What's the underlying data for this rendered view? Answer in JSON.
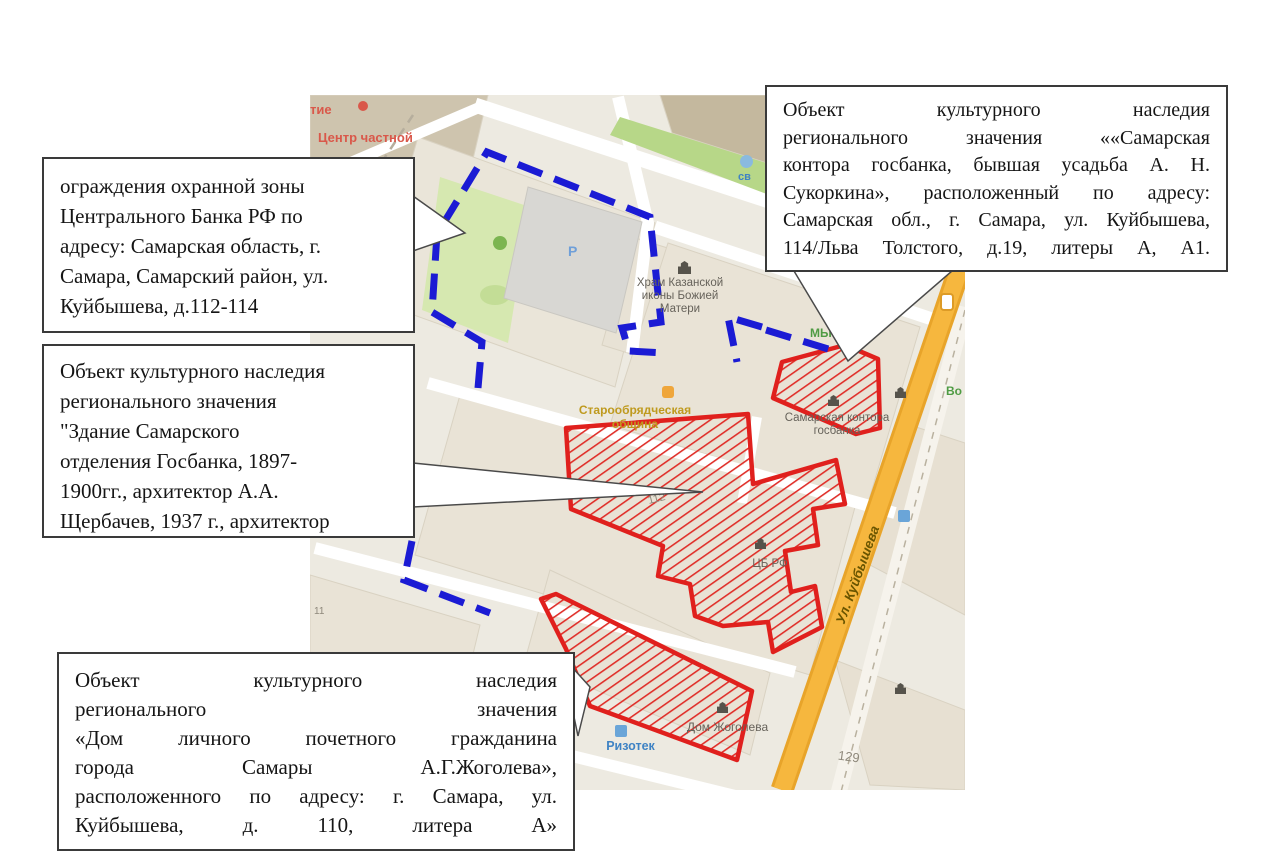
{
  "figure": {
    "boxes": {
      "protection_zone": {
        "lines": [
          "ограждения охранной зоны",
          "Центрального Банка РФ по",
          "адресу: Самарская область, г.",
          "Самара, Самарский район, ул.",
          "Куйбышева, д.112-114"
        ]
      },
      "gosbank_building": {
        "lines": [
          "Объект культурного наследия",
          "регионального значения",
          "\"Здание Самарского",
          "отделения Госбанка, 1897-",
          "1900гг., архитектор А.А.",
          "Щербачев, 1937 г., архитектор"
        ]
      },
      "kontora_gosbanka": {
        "lines": [
          "Объект культурного наследия",
          "регионального значения ««Самарская",
          "контора госбанка, бывшая усадьба А. Н.",
          "Сукоркина», расположенный по адресу:",
          "Самарская обл., г. Самара, ул. Куйбышева,",
          "114/Льва Толстого, д.19, литеры А, А1."
        ]
      },
      "zhogolev_house": {
        "lines": [
          "Объект культурного наследия",
          "регионального значения",
          "«Дом личного почетного гражданина",
          "города Самары А.Г.Жоголева»,",
          "расположенного по адресу: г. Самара, ул.",
          "Куйбышева, д. 110, литера А»"
        ]
      }
    }
  },
  "map": {
    "labels": {
      "poi_fragment_tie": "тие",
      "poi_center_chastnoy": "Центр частной",
      "church": [
        "Храм Казанской",
        "иконы Божией",
        "Матери"
      ],
      "old_believers": [
        "Старообрядческая",
        "община"
      ],
      "kontora": [
        "Самарская контора",
        "госбанка"
      ],
      "cb_rf": "ЦБ РФ",
      "dom_zhogoleva": "Дом Жоголева",
      "rizotek": "Ризотек",
      "sv_fragment": "св",
      "green_fragment_my": "МЫ",
      "green_fragment_vo": "Во",
      "house_112": "112",
      "house_129": "129",
      "house_11": "11",
      "parking": "Р",
      "street_kuybysheva": "Ул. Куйбышева"
    },
    "colors": {
      "protected_zone_boundary": "#1b1bd4",
      "heritage_object_outline": "#e0201d",
      "main_road_fill": "#f6b73e",
      "poi_red": "#d9584a",
      "poi_green": "#4f9b43",
      "poi_blue": "#3f83c4",
      "poi_orange": "#bf9a1e"
    }
  }
}
